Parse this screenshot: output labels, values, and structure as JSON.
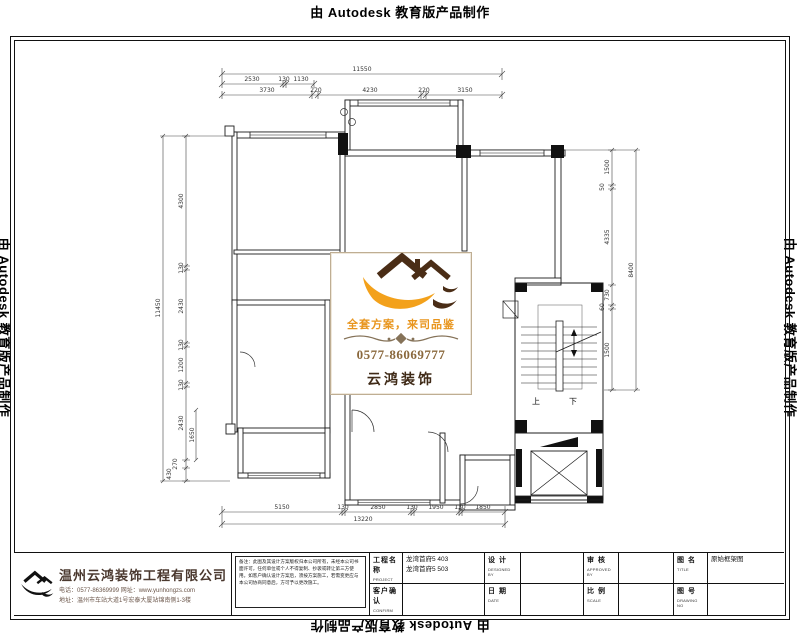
{
  "stamp": {
    "text": "由 Autodesk 教育版产品制作"
  },
  "watermark": {
    "slogan": "全套方案，来司品鉴",
    "phone": "0577-86069777",
    "brand": "云鸿装饰"
  },
  "plan": {
    "dims": {
      "top_total": "11550",
      "top_sub": [
        "2530",
        "130",
        "1130"
      ],
      "top_main": [
        "3730",
        "220",
        "4230",
        "220",
        "3150"
      ],
      "bottom_main": [
        "5150",
        "130",
        "2850",
        "130",
        "1950",
        "130",
        "1850"
      ],
      "bottom_total": "13220",
      "left_main": [
        "4300",
        "130",
        "2430",
        "130",
        "1200",
        "130",
        "2430",
        "270",
        "430"
      ],
      "left_inner": "1650",
      "left_total": "11450",
      "right_main": [
        "1500",
        "50",
        "4335",
        "730",
        "60",
        "1500"
      ],
      "right_total": "8400",
      "stair_up": "上",
      "stair_down": "下"
    }
  },
  "titleblock": {
    "company": {
      "name": "温州云鸿装饰工程有限公司",
      "phone_line": "电话：0577-86369999 网址：www.yunhongzs.com",
      "address_line": "地址：温州市车站大道1号宏泰大厦站锦南侧1-3楼"
    },
    "notes": "备注：此图及其设计方案版权归本公司所有，未经本公司书面许可，任何单位或个人不得复制、抄袭或转让第三方使用。如客户确认设计方案后，须按方案施工，若需变更应与本公司协商同意后，方可予以更改施工。",
    "cells": {
      "project_label": "工程名称",
      "project_sub": "PROJECT",
      "project_value1": "龙湾首府5 403",
      "project_value2": "龙湾首府5 503",
      "confirm_label": "客户确认",
      "confirm_sub": "CONFIRM",
      "design_label": "设 计",
      "design_sub": "DESIGNED BY",
      "date_label": "日 期",
      "date_sub": "DATE",
      "approve_label": "审 核",
      "approve_sub": "APPROVED BY",
      "scale_label": "比 例",
      "scale_sub": "SCALE",
      "title_label": "图 名",
      "title_sub": "TITLE",
      "title_value": "原始框架图",
      "no_label": "图 号",
      "no_sub": "DRAWING NO"
    }
  }
}
